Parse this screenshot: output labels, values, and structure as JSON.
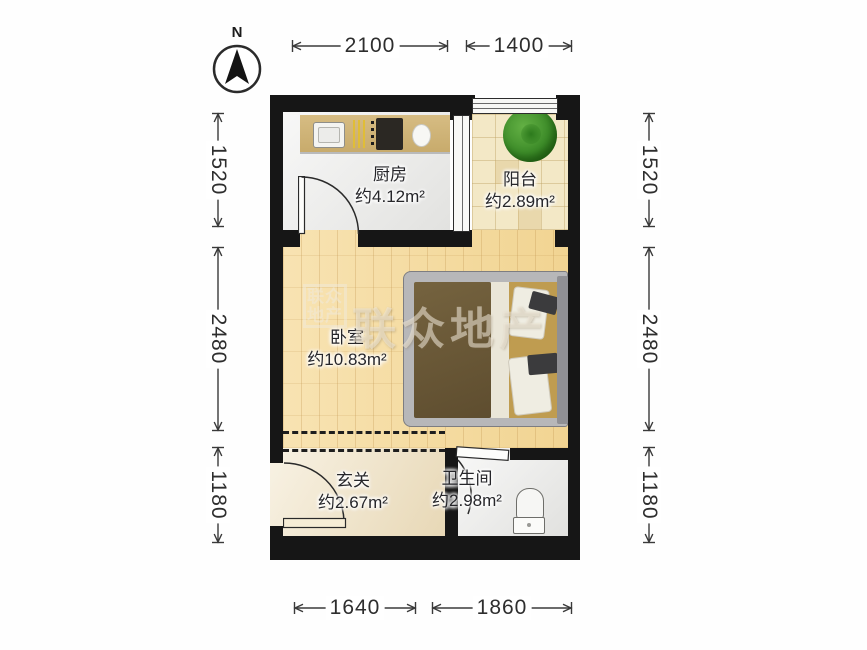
{
  "compass": {
    "label": "N"
  },
  "dimensions": {
    "top": [
      "2100",
      "1400"
    ],
    "bottom": [
      "1640",
      "1860"
    ],
    "left": [
      "1520",
      "2480",
      "1180"
    ],
    "right": [
      "1520",
      "2480",
      "1180"
    ]
  },
  "rooms": [
    {
      "name": "厨房",
      "area": "约4.12m²"
    },
    {
      "name": "阳台",
      "area": "约2.89m²"
    },
    {
      "name": "卧室",
      "area": "约10.83m²"
    },
    {
      "name": "玄关",
      "area": "约2.67m²"
    },
    {
      "name": "卫生间",
      "area": "约2.98m²"
    }
  ],
  "watermark": {
    "text": "联众地产"
  },
  "colors": {
    "wall": "#161616",
    "wood_floor": "#f5dca4",
    "balcony_tile": "#f3e8c6",
    "marble_floor": "#ebebe9",
    "entry_floor": "#f1e5c9",
    "counter": "#cfb478",
    "blanket": "#6b5938",
    "plant": "#3d8c29",
    "watermark": "#f0e9db"
  }
}
